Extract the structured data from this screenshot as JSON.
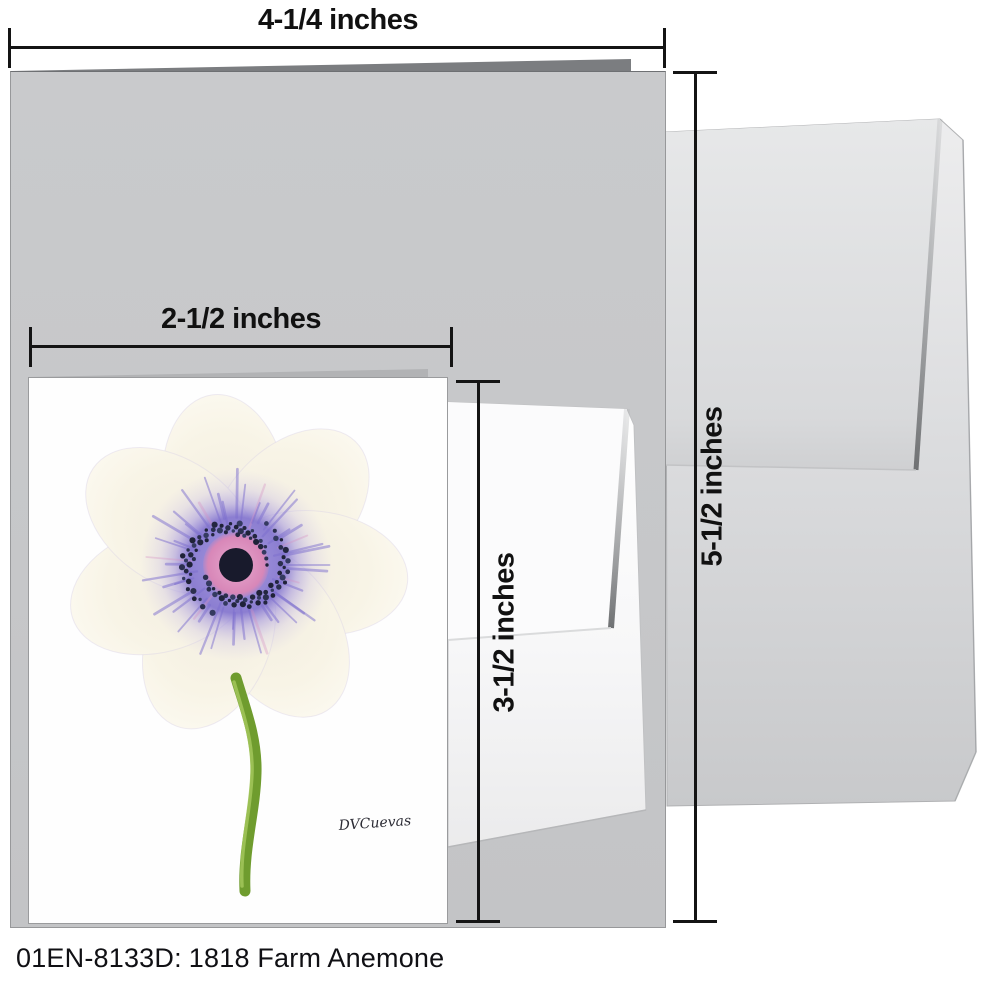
{
  "caption": {
    "sku_label": "01EN-8133D:",
    "title": "1818 Farm Anemone"
  },
  "dimensions": {
    "card_width": "4-1/4 inches",
    "card_height": "5-1/2 inches",
    "insert_width": "2-1/2 inches",
    "insert_height": "3-1/2 inches"
  },
  "artwork": {
    "signature": "DVCuevas",
    "subject": "white anemone flower with purple center and green stem",
    "colors": {
      "petal_cream": "#f8f3e4",
      "petal_edge": "#efe9f4",
      "ring_purple": "#8678d0",
      "ray_purple": "#7c6ecd",
      "ray_pink": "#d893c2",
      "stamen_palette": [
        "#1f2238",
        "#2b2f4e",
        "#343a60",
        "#23263f"
      ],
      "pink_disc": "#dd93c0",
      "center_dark": "#181a2c",
      "stem_green": "#6f9c2e",
      "stem_highlight": "#a6c95e"
    }
  },
  "mockup": {
    "large_card_color": "#c6c7c9",
    "envelope_color": "#dcdddf",
    "dimension_line_color": "#141414"
  }
}
